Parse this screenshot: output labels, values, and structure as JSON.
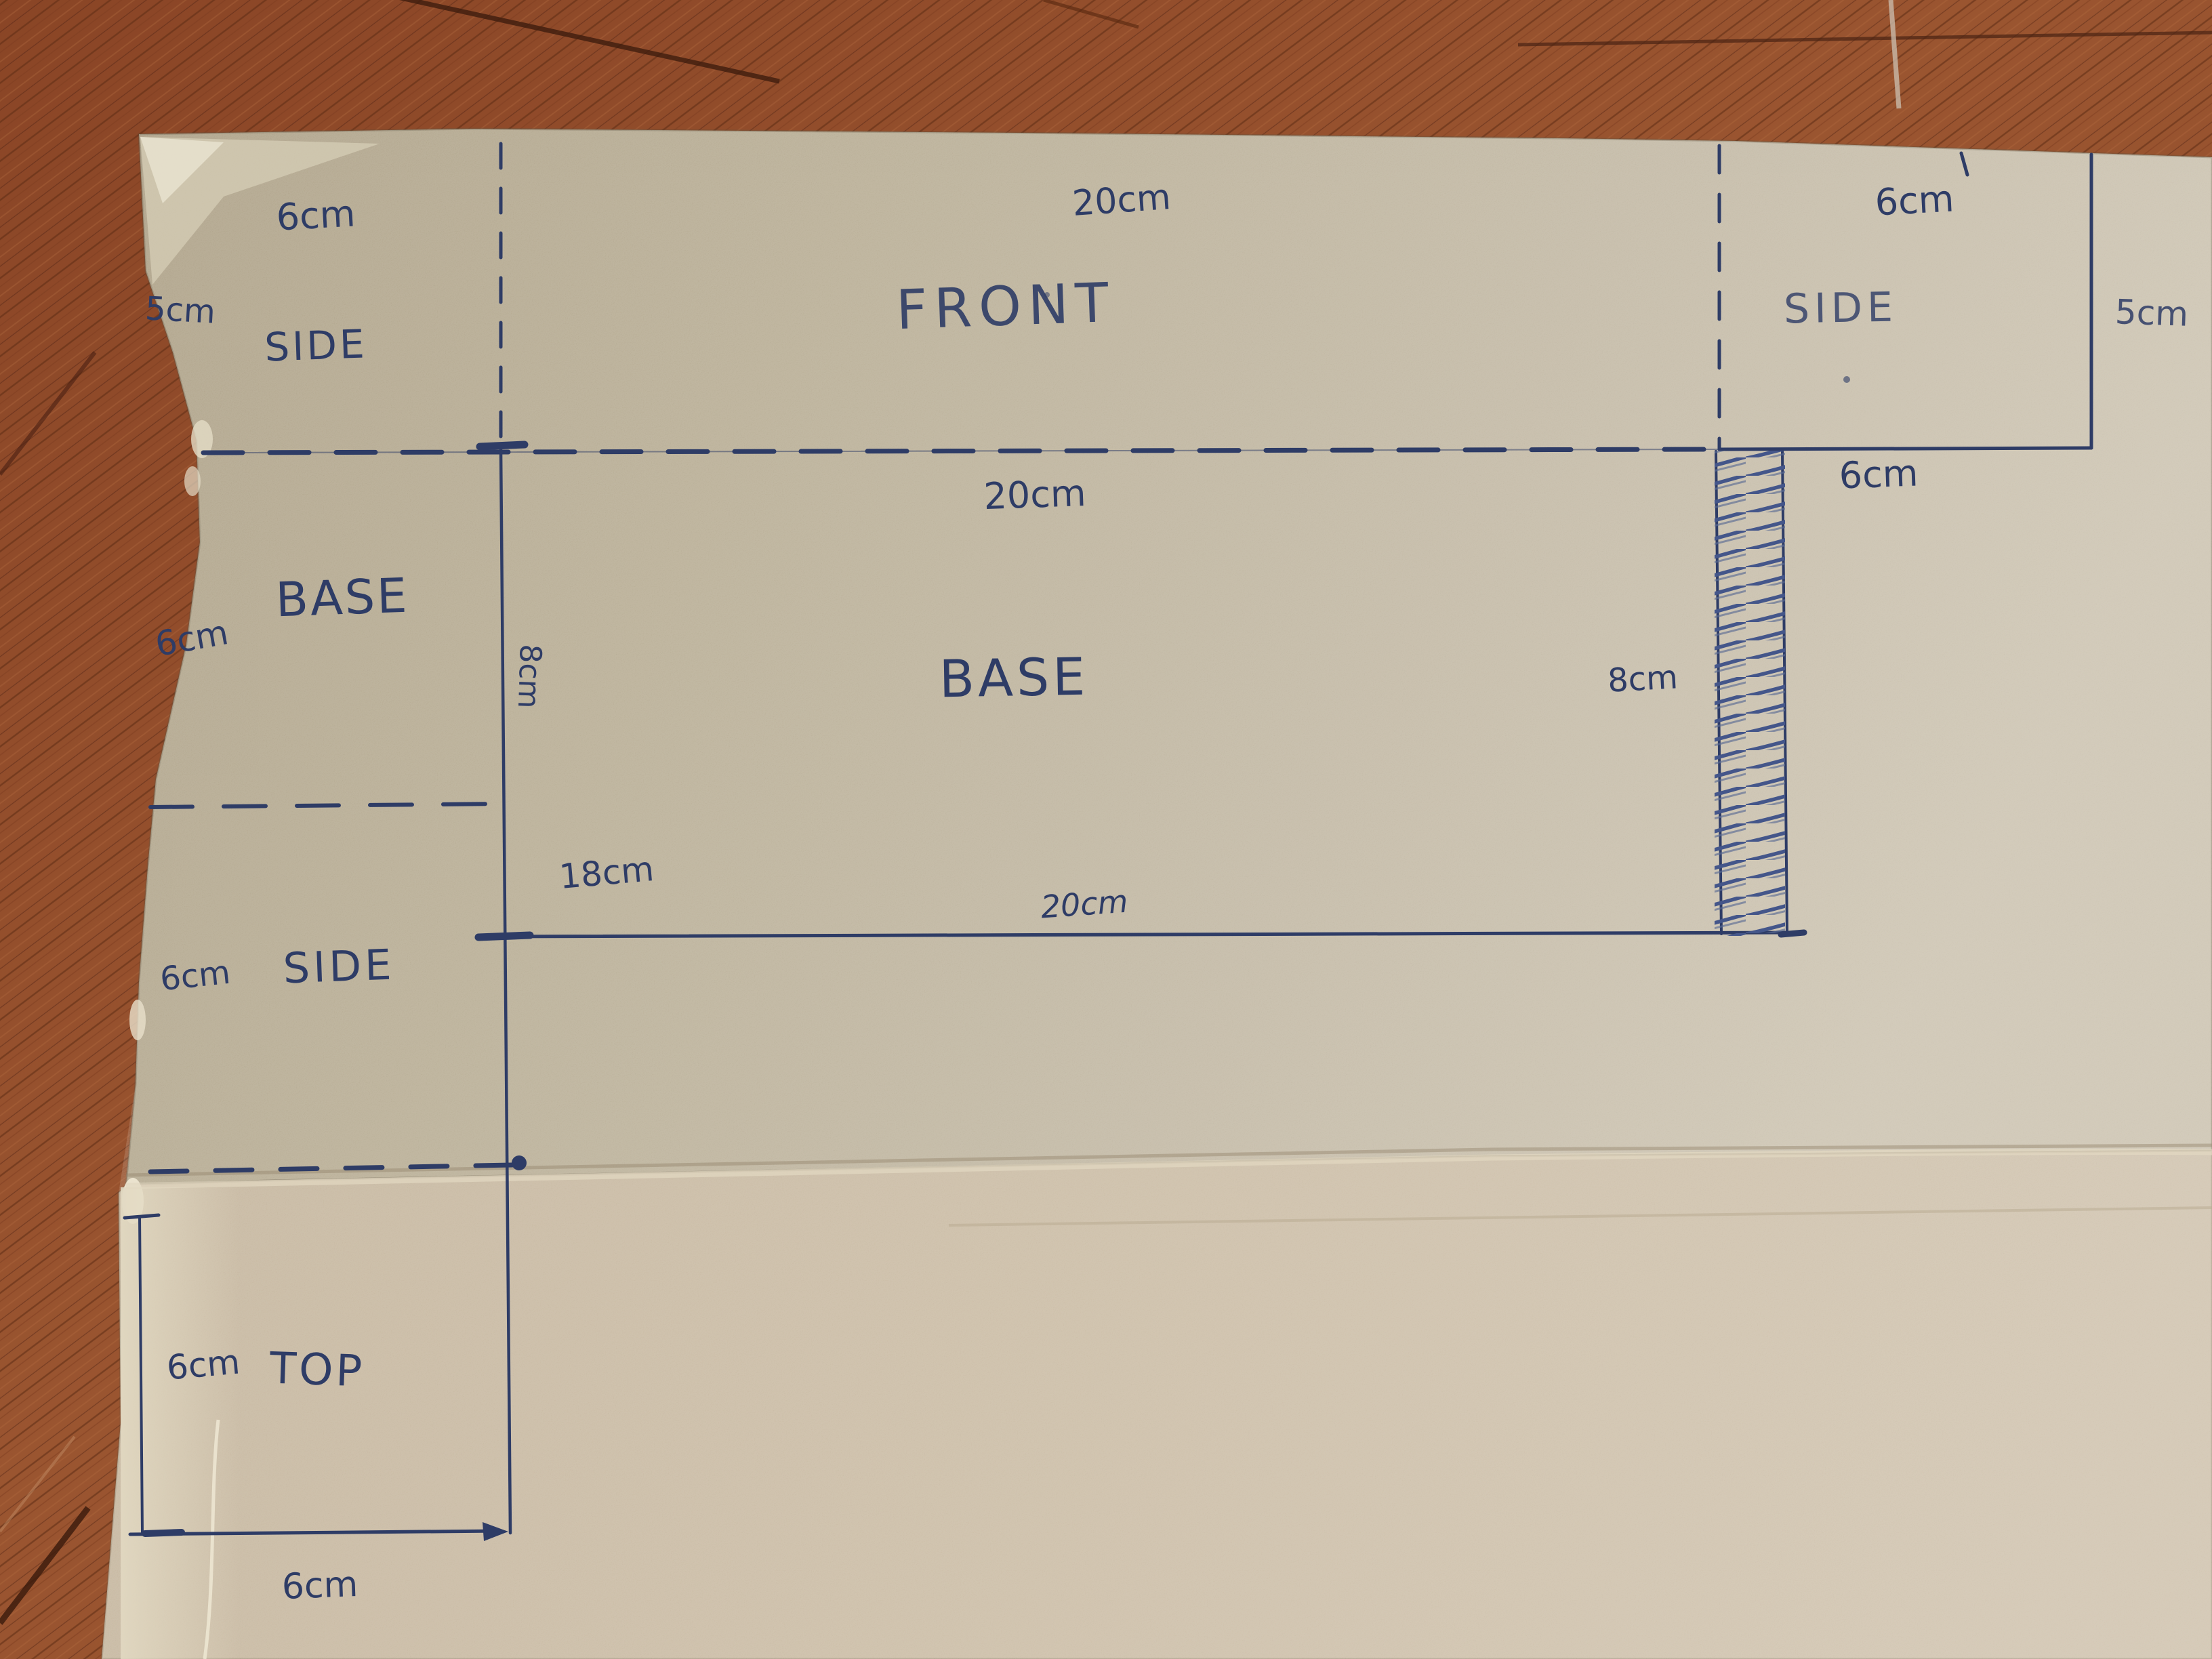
{
  "scene": {
    "description": "Hand-drawn cardboard box net pattern photographed on a wood floor",
    "ink_color": "#2e3c66",
    "cardboard_upper_color": "#b3a78e",
    "cardboard_lower_color": "#c7b9a4",
    "wood_floor_color": "#8a4526"
  },
  "labels": {
    "side_top_left": {
      "name": "SIDE",
      "top": "6cm",
      "left": "5cm"
    },
    "front": {
      "name": "FRONT",
      "top": "20cm"
    },
    "side_top_right": {
      "name": "SIDE",
      "top": "6cm",
      "right": "5cm"
    },
    "base_strip": {
      "top": "20cm",
      "glue_width": "6cm"
    },
    "base_left_flap": {
      "name": "BASE",
      "left": "6cm"
    },
    "base_main": {
      "name": "BASE",
      "left_height": "8cm",
      "right_height": "8cm",
      "bottom_inner": "18cm",
      "bottom": "20cm"
    },
    "side_left_flap": {
      "name": "SIDE",
      "left": "6cm"
    },
    "top_panel": {
      "name": "TOP",
      "left": "6cm",
      "bottom": "6cm"
    }
  }
}
